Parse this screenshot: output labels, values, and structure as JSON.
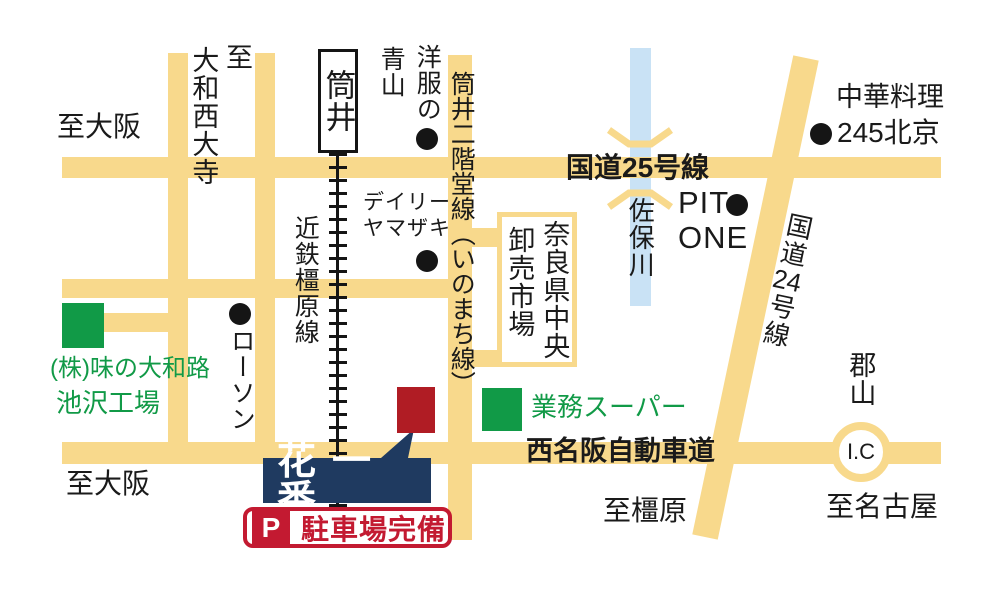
{
  "colors": {
    "road_yellow": "#F8D98C",
    "river_blue": "#C9E2F5",
    "landmark_green": "#119A47",
    "shop_navy": "#1F3A60",
    "marker_red": "#B01C24",
    "parking_red": "#C31A31"
  },
  "roads": {
    "route25_label": "国道25号線",
    "route24_label_pre": "国道",
    "route24_label_num": "24",
    "route24_label_post": "号線",
    "nishimeihan_label": "西名阪自動車道",
    "inomachi_label": "筒井二階堂線（いのまち線）",
    "kintetsu_label": "近鉄橿原線"
  },
  "river": {
    "label": "佐保川"
  },
  "station": {
    "label": "筒井"
  },
  "directions": {
    "to_osaka_top": "至大阪",
    "to_osaka_bottom": "至大阪",
    "to_saidaiji_prefix": "至",
    "to_saidaiji": "大和西大寺",
    "to_kashihara": "至橿原",
    "to_nagoya": "至名古屋",
    "koriyama": "郡山",
    "ic": "I.C"
  },
  "landmarks": {
    "aoyama_col1": "洋服の",
    "aoyama_col2": "青山",
    "daily_line1": "デイリー",
    "daily_line2": "ヤマザキ",
    "market_col1": "奈良県中央",
    "market_col2": "卸売市場",
    "chuka_line1": "中華料理",
    "chuka_line2": "245北京",
    "pitone_line1": "PIT",
    "pitone_line2": "ONE",
    "lawson": "ローソン",
    "ajino_line1": "(株)味の大和路",
    "ajino_line2": "池沢工場",
    "gyomu": "業務スーパー"
  },
  "shop": {
    "name": "花一番",
    "parking_icon": "P",
    "parking_label": "駐車場完備"
  }
}
